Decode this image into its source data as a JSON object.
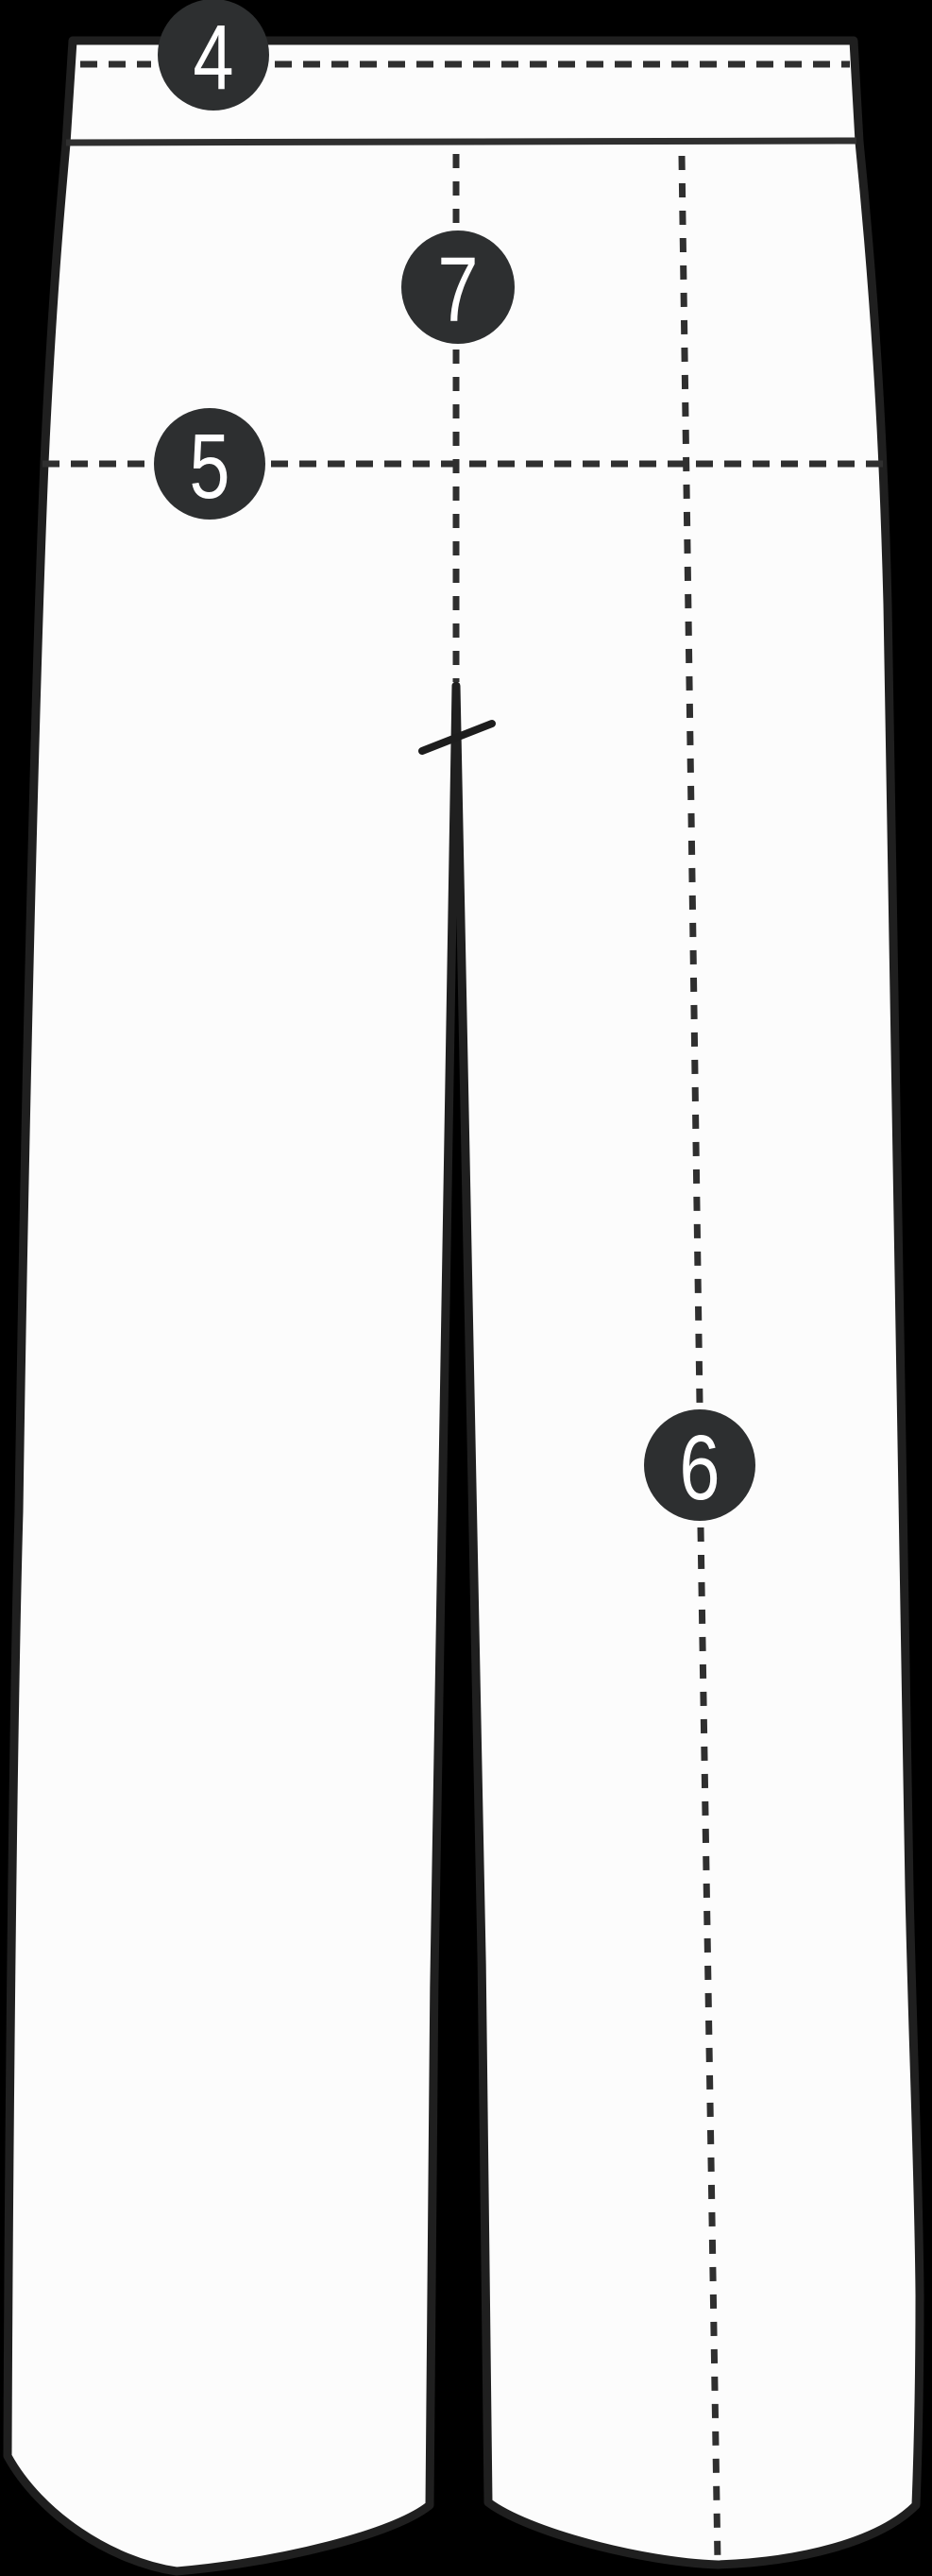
{
  "diagram": {
    "badges": [
      {
        "label": "4"
      },
      {
        "label": "5"
      },
      {
        "label": "6"
      },
      {
        "label": "7"
      }
    ],
    "colors": {
      "background": "#000000",
      "garment_fill": "#fcfcfc",
      "outline": "#1f1f1f",
      "seam_line": "#2f2f2f",
      "badge_fill": "#2d2f30",
      "badge_text": "#ffffff"
    }
  }
}
